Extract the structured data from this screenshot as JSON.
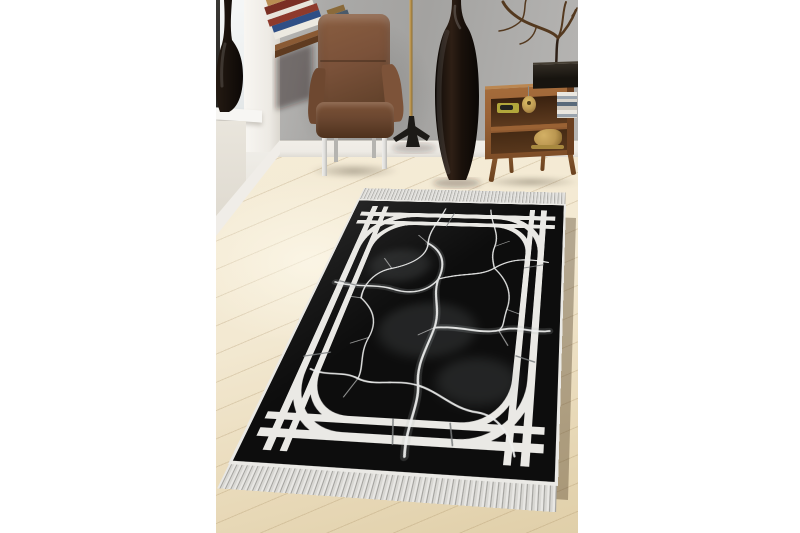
{
  "image": {
    "type": "product-photo",
    "subject": "Black marble-pattern area rug with white double-line border frame and fringed ends, staged in a living room"
  },
  "palette": {
    "rugBlack": "#0d0d0d",
    "rugWhite": "#eae9e5",
    "veinWhite": "#f0f1f0",
    "floorLight": "#f3e9d2",
    "floorDark": "#e0cfa9",
    "wallGray": "#a3a2a0",
    "wallWhite": "#f0eee9",
    "windowLight": "#eef1f1",
    "baseboard": "#eeebe5",
    "leather": "#7b523a",
    "leatherDark": "#583923",
    "chrome": "#e0dfdc",
    "wood": "#9a6236",
    "woodDark": "#5f3a1e",
    "gold": "#bb9751",
    "vaseBlack": "#181009",
    "branch": "#54391f",
    "boxBlack": "#17140f",
    "trayYellow": "#b2a73b",
    "fringeLight": "#e8e7e4",
    "fringeDark": "#a5a4a0",
    "shadow": "rgba(85,68,42,0.4)"
  },
  "objects": {
    "rug": {
      "label": "black marble-vein rug",
      "field_color": "black",
      "veins": "white crack veins",
      "border": "double white stripe frame with quarter-arc corners and outer edge binding",
      "fringe": "silver-white tassel fringe on both short ends"
    },
    "armchair": {
      "label": "brown leather armchair on chrome frame base"
    },
    "corner_desk": {
      "label": "wall-mounted corner desk with stacked books"
    },
    "floor_lamp": {
      "label": "brass pole floor lamp with black tripod base"
    },
    "tall_vase": {
      "label": "tall dark bottle-shaped floor vase"
    },
    "window_vase": {
      "label": "dark round vase on white windowsill"
    },
    "sideboard": {
      "label": "mid-century walnut sideboard with splayed legs"
    },
    "sideboard_items": [
      "black media box",
      "olive tray",
      "gold medallion ornament",
      "stacked books",
      "gold animal figurine"
    ],
    "branch_decor": {
      "label": "dry branch sculpture above sideboard"
    },
    "room": {
      "label": "gray wall, white window wall, light oak plank floor"
    }
  }
}
